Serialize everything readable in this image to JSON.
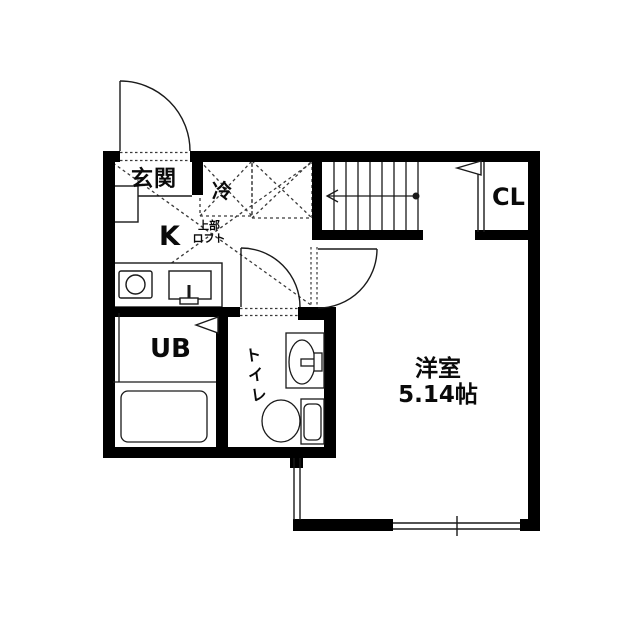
{
  "plan": {
    "type": "apartment-floorplan",
    "rooms": {
      "entrance": {
        "label": "玄関"
      },
      "refrigerator": {
        "label": "冷"
      },
      "kitchen": {
        "label": "K"
      },
      "loft": {
        "label_line1": "上部",
        "label_line2": "ロフト"
      },
      "closet": {
        "label": "CL"
      },
      "unit_bath": {
        "label": "UB"
      },
      "toilet": {
        "label": "トイレ"
      },
      "main_room": {
        "label": "洋室",
        "size": "5.14帖"
      }
    },
    "fixtures": [
      "entrance-door-swing",
      "refrigerator-space-x",
      "loft-outline-x",
      "stove-burner",
      "kitchen-sink",
      "stairs-with-direction-arrow",
      "closet-door",
      "folding-door-triangle-ub",
      "folding-door-triangle-cl",
      "bathtub",
      "washbasin",
      "toilet-bowl",
      "room-door-swing",
      "toilet-door-swing",
      "sliding-window-south",
      "window-west"
    ],
    "colors": {
      "wall": "#000000",
      "line": "#1a1a1a",
      "dashed_line": "#3a3a3a",
      "background": "#ffffff"
    }
  }
}
